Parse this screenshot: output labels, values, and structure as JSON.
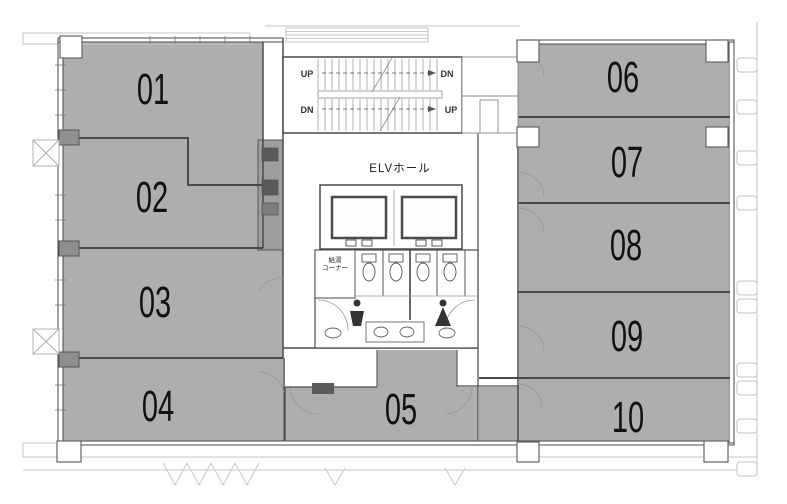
{
  "plan": {
    "type": "office-floor-plan",
    "rooms": [
      {
        "id": "01",
        "label": "01"
      },
      {
        "id": "02",
        "label": "02"
      },
      {
        "id": "03",
        "label": "03"
      },
      {
        "id": "04",
        "label": "04"
      },
      {
        "id": "05",
        "label": "05"
      },
      {
        "id": "06",
        "label": "06"
      },
      {
        "id": "07",
        "label": "07"
      },
      {
        "id": "08",
        "label": "08"
      },
      {
        "id": "09",
        "label": "09"
      },
      {
        "id": "10",
        "label": "10"
      }
    ],
    "core": {
      "elv_hall_label": "ELVホール",
      "pantry_line1": "給湯",
      "pantry_line2": "コーナー",
      "stairs": {
        "up_top": "UP",
        "dn_top": "DN",
        "dn_bottom": "DN",
        "up_bottom": "UP"
      }
    },
    "colors": {
      "room_fill": "#aeaeae",
      "shaft_fill": "#9e9e9e",
      "wall": "#4a4a4a",
      "light_line": "#c6c6c6"
    }
  }
}
